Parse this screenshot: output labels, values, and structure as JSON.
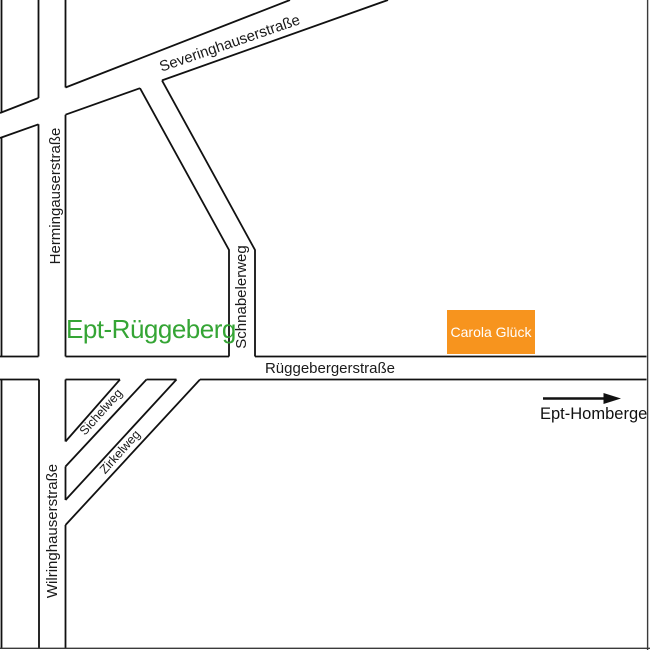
{
  "map": {
    "place": {
      "label": "Ept-Rüggeberg"
    },
    "marker": {
      "label": "Carola Glück"
    },
    "direction": {
      "label": "Ept-Homberge"
    },
    "streets": {
      "severinghauserstrasse": "Severinghauserstraße",
      "hermingauserstrasse": "Hermingauserstraße",
      "schnabelerweg": "Schnabelerweg",
      "rueggebergerstrasse": "Rüggebergerstraße",
      "sichelweg": "Sichelweg",
      "zirkelweg": "Zirkelweg",
      "wilringhauserstrasse": "Wilringhauserstraße"
    },
    "colors": {
      "road_outline": "#111111",
      "place_label_green": "#35a535",
      "marker_orange": "#f7941e",
      "marker_text": "#ffffff",
      "border_gray": "#3a3a3a"
    }
  }
}
